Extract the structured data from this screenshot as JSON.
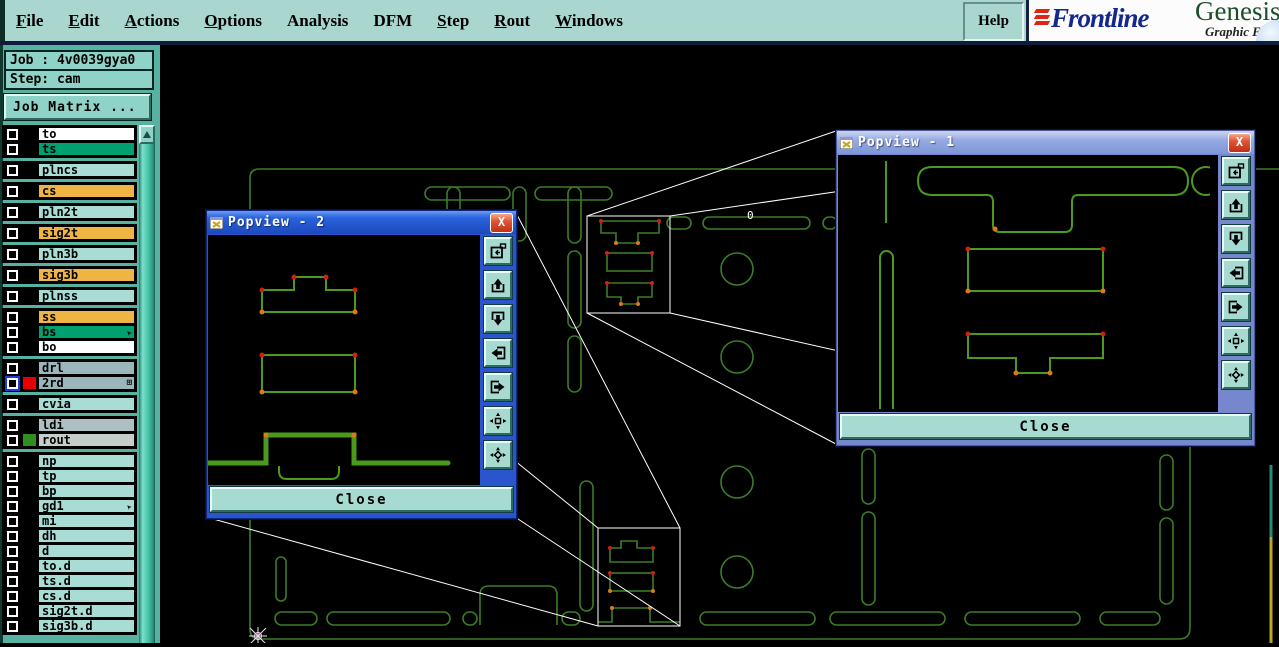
{
  "menu": {
    "items": [
      {
        "label": "File",
        "underline": 0
      },
      {
        "label": "Edit",
        "underline": 0
      },
      {
        "label": "Actions",
        "underline": 0
      },
      {
        "label": "Options",
        "underline": 0
      },
      {
        "label": "Analysis",
        "underline": -1
      },
      {
        "label": "DFM",
        "underline": -1
      },
      {
        "label": "Step",
        "underline": 0
      },
      {
        "label": "Rout",
        "underline": 0
      },
      {
        "label": "Windows",
        "underline": 0
      }
    ],
    "help_label": "Help"
  },
  "brand": {
    "name": "Frontline",
    "product": "Genesis",
    "subtitle": "Graphic E",
    "name_color": "#14288c",
    "accent_color": "#e02414",
    "product_color": "#1d4d28"
  },
  "job_panel": {
    "job_line": "Job : 4v0039gya0",
    "step_line": "Step: cam",
    "job_matrix_button": "Job Matrix ..."
  },
  "layers": {
    "groups": [
      {
        "rows": [
          {
            "name": "to",
            "label_bg": "#ffffff"
          },
          {
            "name": "ts",
            "label_bg": "#00a070"
          }
        ]
      },
      {
        "rows": [
          {
            "name": "plncs",
            "label_bg": "#aadcd6"
          }
        ]
      },
      {
        "rows": [
          {
            "name": "cs",
            "label_bg": "#f0b445"
          }
        ]
      },
      {
        "rows": [
          {
            "name": "pln2t",
            "label_bg": "#aadcd6"
          }
        ]
      },
      {
        "rows": [
          {
            "name": "sig2t",
            "label_bg": "#f0b445"
          }
        ]
      },
      {
        "rows": [
          {
            "name": "pln3b",
            "label_bg": "#aadcd6"
          }
        ]
      },
      {
        "rows": [
          {
            "name": "sig3b",
            "label_bg": "#f0b445"
          }
        ]
      },
      {
        "rows": [
          {
            "name": "plnss",
            "label_bg": "#aadcd6"
          }
        ]
      },
      {
        "rows": [
          {
            "name": "ss",
            "label_bg": "#f0b445"
          },
          {
            "name": "bs",
            "label_bg": "#00a070",
            "icon": "cursor-arrow"
          },
          {
            "name": "bo",
            "label_bg": "#ffffff"
          }
        ]
      },
      {
        "rows": [
          {
            "name": "drl",
            "label_bg": "#9cb5bb"
          },
          {
            "name": "2rd",
            "label_bg": "#9cb5bb",
            "swatch": "#e80000",
            "selected": true,
            "icon": "grid"
          }
        ]
      },
      {
        "rows": [
          {
            "name": "cvia",
            "label_bg": "#aadcd6"
          }
        ]
      },
      {
        "rows": [
          {
            "name": "ldi",
            "label_bg": "#aebfc2"
          },
          {
            "name": "rout",
            "label_bg": "#c6cec9",
            "swatch": "#2f8f1f"
          }
        ]
      },
      {
        "rows": [
          {
            "name": "np",
            "label_bg": "#aadcd6"
          },
          {
            "name": "tp",
            "label_bg": "#aadcd6"
          },
          {
            "name": "bp",
            "label_bg": "#aadcd6"
          },
          {
            "name": "gd1",
            "label_bg": "#aadcd6",
            "icon": "cursor-arrow"
          },
          {
            "name": "mi",
            "label_bg": "#aadcd6"
          },
          {
            "name": "dh",
            "label_bg": "#aadcd6"
          },
          {
            "name": "d",
            "label_bg": "#aadcd6"
          },
          {
            "name": "to.d",
            "label_bg": "#aadcd6"
          },
          {
            "name": "ts.d",
            "label_bg": "#aadcd6"
          },
          {
            "name": "cs.d",
            "label_bg": "#aadcd6"
          },
          {
            "name": "sig2t.d",
            "label_bg": "#aadcd6"
          },
          {
            "name": "sig3b.d",
            "label_bg": "#aadcd6"
          }
        ]
      }
    ]
  },
  "popviews": [
    {
      "title": "Popview - 2",
      "close_label": "Close",
      "state": "active",
      "icons": [
        "prev-view-icon",
        "pan-up-icon",
        "pan-down-icon",
        "pan-left-icon",
        "pan-right-icon",
        "zoom-extents-icon",
        "center-view-icon"
      ]
    },
    {
      "title": "Popview - 1",
      "close_label": "Close",
      "state": "inactive",
      "icons": [
        "prev-view-icon",
        "pan-up-icon",
        "pan-down-icon",
        "pan-left-icon",
        "pan-right-icon",
        "zoom-extents-icon",
        "center-view-icon"
      ]
    }
  ],
  "canvas": {
    "annotation": "0",
    "background": "#000000",
    "board_color": "#3c7c28",
    "popview_shape_color": "#4a9a1e",
    "leader_line_color": "#ffffff",
    "highlight_dot_red": "#cc2010",
    "highlight_dot_orange": "#e07818"
  }
}
